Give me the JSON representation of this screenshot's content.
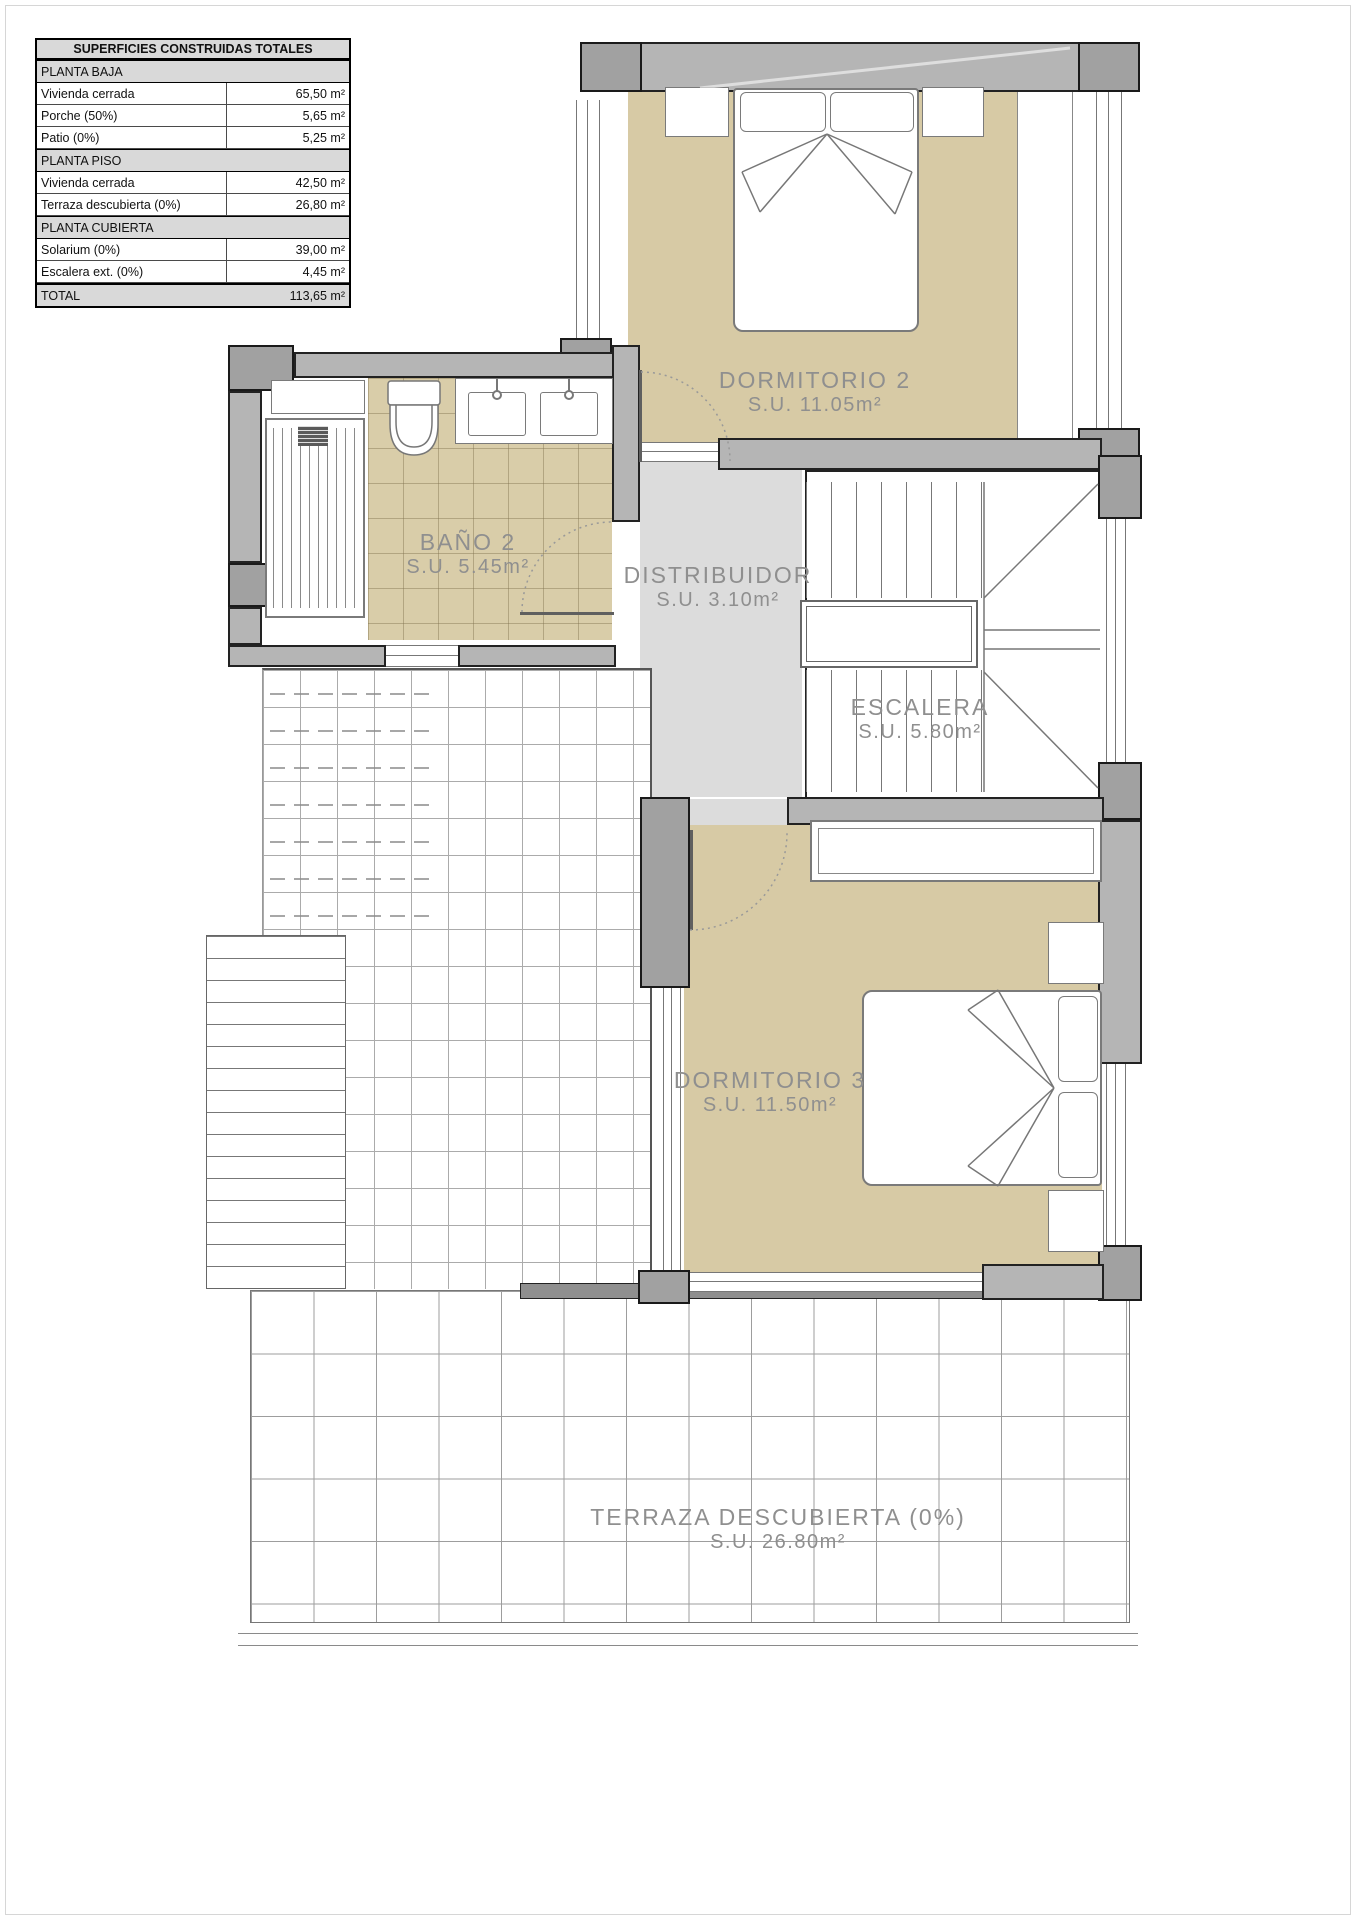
{
  "surfaces_table": {
    "title": "SUPERFICIES CONSTRUIDAS TOTALES",
    "sections": [
      {
        "header": "PLANTA BAJA",
        "rows": [
          {
            "label": "Vivienda cerrada",
            "value": "65,50 m²"
          },
          {
            "label": "Porche (50%)",
            "value": "5,65 m²"
          },
          {
            "label": "Patio (0%)",
            "value": "5,25 m²"
          }
        ]
      },
      {
        "header": "PLANTA PISO",
        "rows": [
          {
            "label": "Vivienda cerrada",
            "value": "42,50 m²"
          },
          {
            "label": "Terraza descubierta (0%)",
            "value": "26,80 m²"
          }
        ]
      },
      {
        "header": "PLANTA CUBIERTA",
        "rows": [
          {
            "label": "Solarium (0%)",
            "value": "39,00 m²"
          },
          {
            "label": "Escalera ext. (0%)",
            "value": "4,45 m²"
          }
        ]
      }
    ],
    "total": {
      "label": "TOTAL",
      "value": "113,65 m²"
    }
  },
  "rooms": {
    "dormitorio2": {
      "name": "DORMITORIO 2",
      "area": "S.U. 11.05m²"
    },
    "bano2": {
      "name": "BAÑO 2",
      "area": "S.U. 5.45m²"
    },
    "distribuidor": {
      "name": "DISTRIBUIDOR",
      "area": "S.U. 3.10m²"
    },
    "escalera": {
      "name": "ESCALERA",
      "area": "S.U. 5.80m²"
    },
    "dormitorio3": {
      "name": "DORMITORIO 3",
      "area": "S.U. 11.50m²"
    },
    "terraza": {
      "name": "TERRAZA DESCUBIERTA (0%)",
      "area": "S.U. 26.80m²"
    }
  },
  "colors": {
    "floor_tan": "#d7caa5",
    "floor_gray": "#dcdcdc",
    "wall_fill": "#b5b5b5",
    "wall_line": "#222222",
    "fixture_line": "#7a7a7a",
    "label_text": "#8f8f8f"
  }
}
